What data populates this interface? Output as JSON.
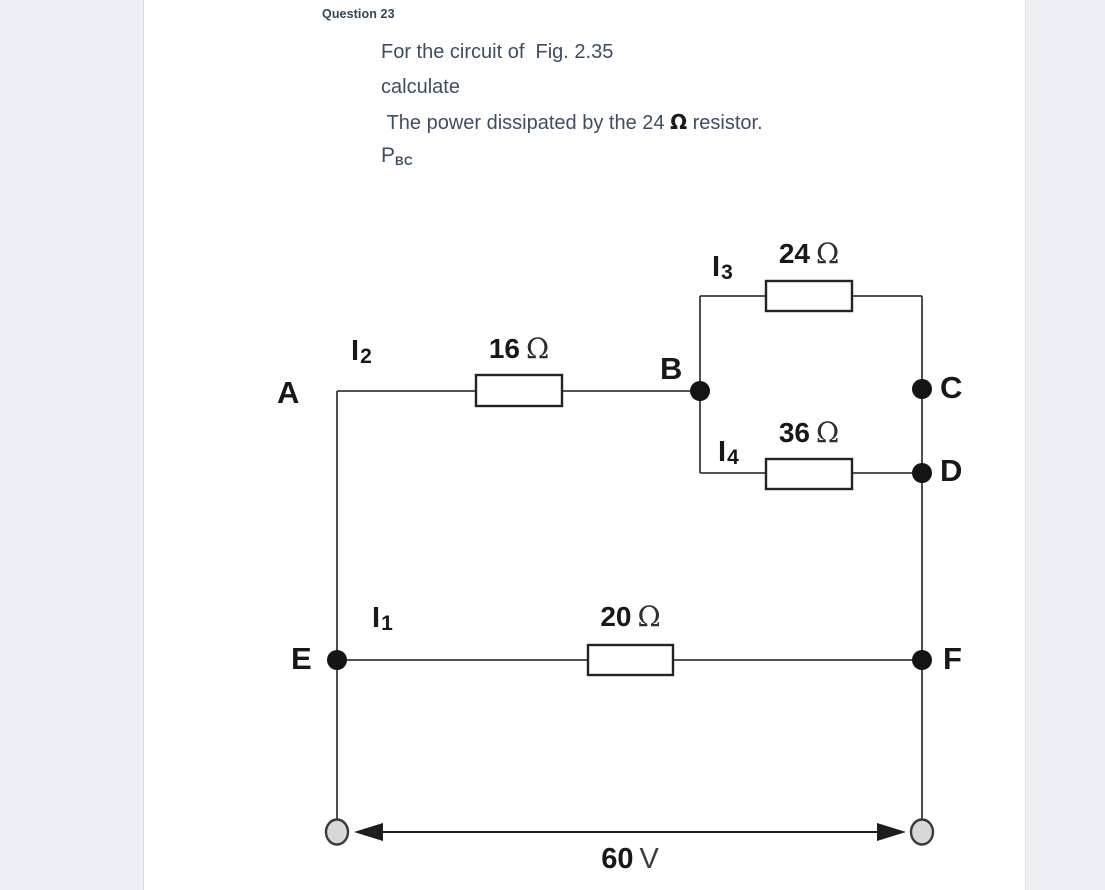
{
  "question": {
    "header": "Question 23",
    "line1": "For the circuit of  Fig. 2.35",
    "line2": "calculate",
    "line3_prefix": " The power dissipated by the 24 ",
    "line3_bold": "Ω",
    "line3_suffix": " resistor.",
    "result_symbol": "P",
    "result_subscript": "BC"
  },
  "circuit": {
    "figure": "Fig. 2.35",
    "nodes": {
      "A": "A",
      "B": "B",
      "C": "C",
      "D": "D",
      "E": "E",
      "F": "F"
    },
    "resistors": {
      "r24": {
        "value": "24",
        "unit": "Ω"
      },
      "r16": {
        "value": "16",
        "unit": "Ω"
      },
      "r36": {
        "value": "36",
        "unit": "Ω"
      },
      "r20": {
        "value": "20",
        "unit": "Ω"
      }
    },
    "currents": {
      "i1": {
        "symbol": "I",
        "sub": "1"
      },
      "i2": {
        "symbol": "I",
        "sub": "2"
      },
      "i3": {
        "symbol": "I",
        "sub": "3"
      },
      "i4": {
        "symbol": "I",
        "sub": "4"
      }
    },
    "source": {
      "value": "60",
      "unit": "V"
    }
  },
  "colors": {
    "question_text": "#3d4e63",
    "panel": "#ffffff",
    "gutter": "#eef0f5",
    "wire": "#3a3a3a",
    "node_dot": "#141414",
    "terminal_fill": "#d8d8d8"
  }
}
